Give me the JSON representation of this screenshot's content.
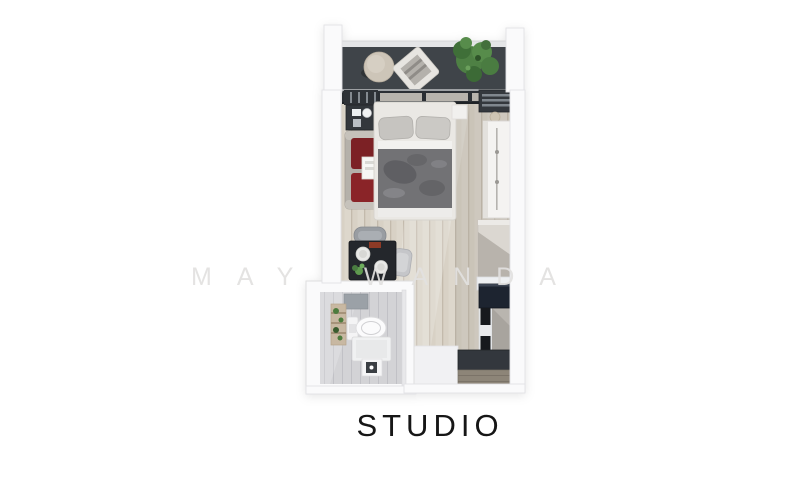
{
  "page": {
    "background": "#ffffff"
  },
  "watermark": {
    "text": "MAY WANDA"
  },
  "plan": {
    "label": "STUDIO",
    "palette": {
      "balcony_floor": "#3f4449",
      "window_frame": "#2b2f34",
      "wood_floor": "#d8d1c5",
      "wall": "#fafafb",
      "bed_blanket": "#727275",
      "armchair_red": "#7c2125",
      "dining_table": "#24272c",
      "counter_navy": "#1d2430",
      "plant_green": "#4e8044",
      "bath_tile": "#d3d3d6",
      "entry_mat": "#8d8578"
    }
  }
}
